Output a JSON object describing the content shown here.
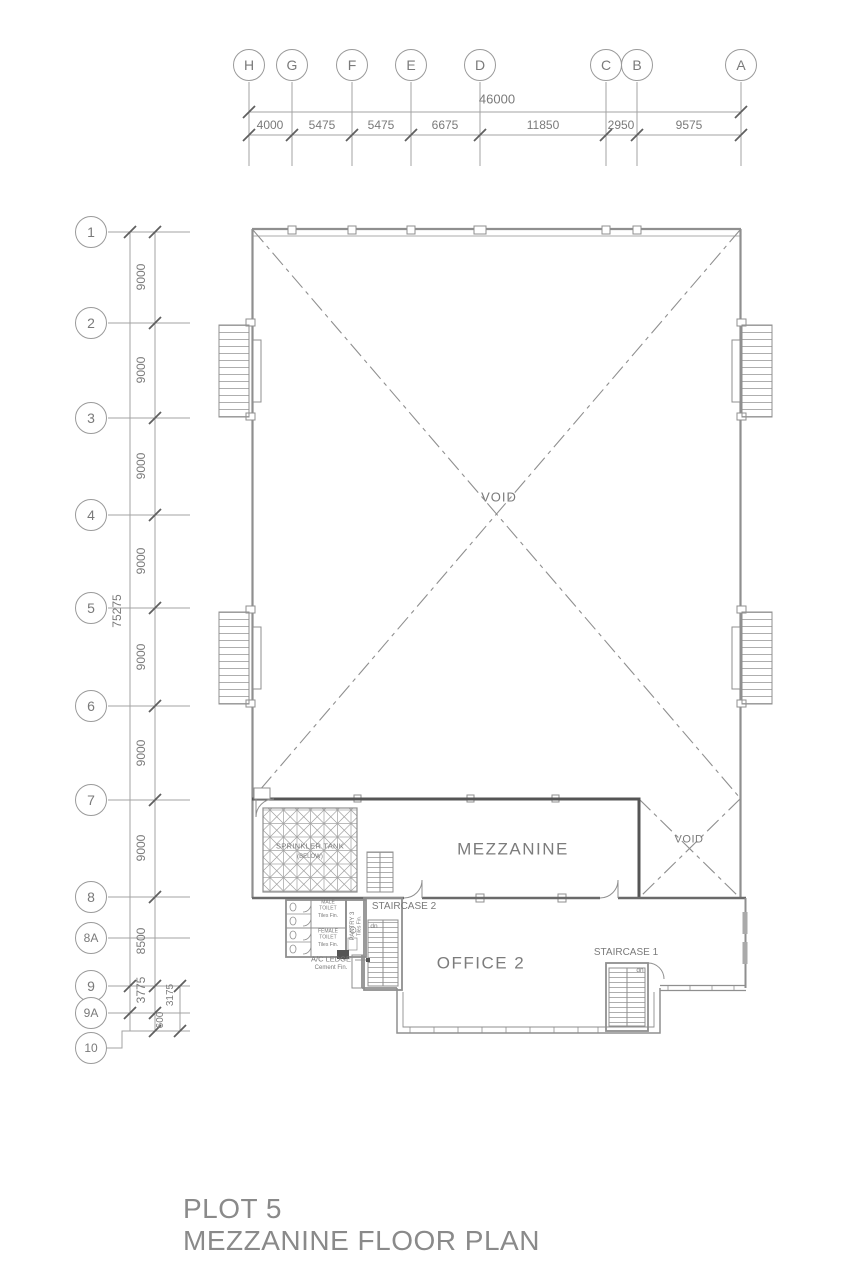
{
  "title": {
    "line1": "PLOT 5",
    "line2": "MEZZANINE FLOOR PLAN"
  },
  "grid_top": {
    "total": "46000",
    "bubbles": [
      "H",
      "G",
      "F",
      "E",
      "D",
      "C",
      "B",
      "A"
    ],
    "segments": [
      "4000",
      "5475",
      "5475",
      "6675",
      "11850",
      "2950",
      "9575"
    ]
  },
  "grid_left": {
    "total": "75275",
    "bubbles": [
      "1",
      "2",
      "3",
      "4",
      "5",
      "6",
      "7",
      "8",
      "8A",
      "9",
      "9A",
      "10"
    ],
    "segments": [
      "9000",
      "9000",
      "9000",
      "9000",
      "9000",
      "9000",
      "9000",
      "8500",
      "3775"
    ],
    "dim_600": "600",
    "dim_3175": "3175"
  },
  "rooms": {
    "void_main": "VOID",
    "void_small": "VOID",
    "mezzanine": "MEZZANINE",
    "office2": "OFFICE 2",
    "sprinkler_tank_line1": "SPRINKLER TANK",
    "sprinkler_tank_line2": "(BELOW)",
    "staircase2": "STAIRCASE 2",
    "staircase1": "STAIRCASE 1",
    "pantry": "PANTRY 3",
    "pantry_finish": "Tiles Fin.",
    "male_toilet": "MALE TOILET",
    "male_toilet_finish": "Tiles Fin.",
    "female_toilet": "FEMALE TOILET",
    "female_toilet_finish": "Tiles Fin.",
    "ac_ledge": "A/C LEDGE",
    "ac_ledge_finish": "Cement Fin.",
    "stair2_dn": "dn",
    "stair1_dn": "dn"
  },
  "colors": {
    "line": "#8f8f8f",
    "line_dark": "#555555",
    "text": "#7a7a7a"
  }
}
